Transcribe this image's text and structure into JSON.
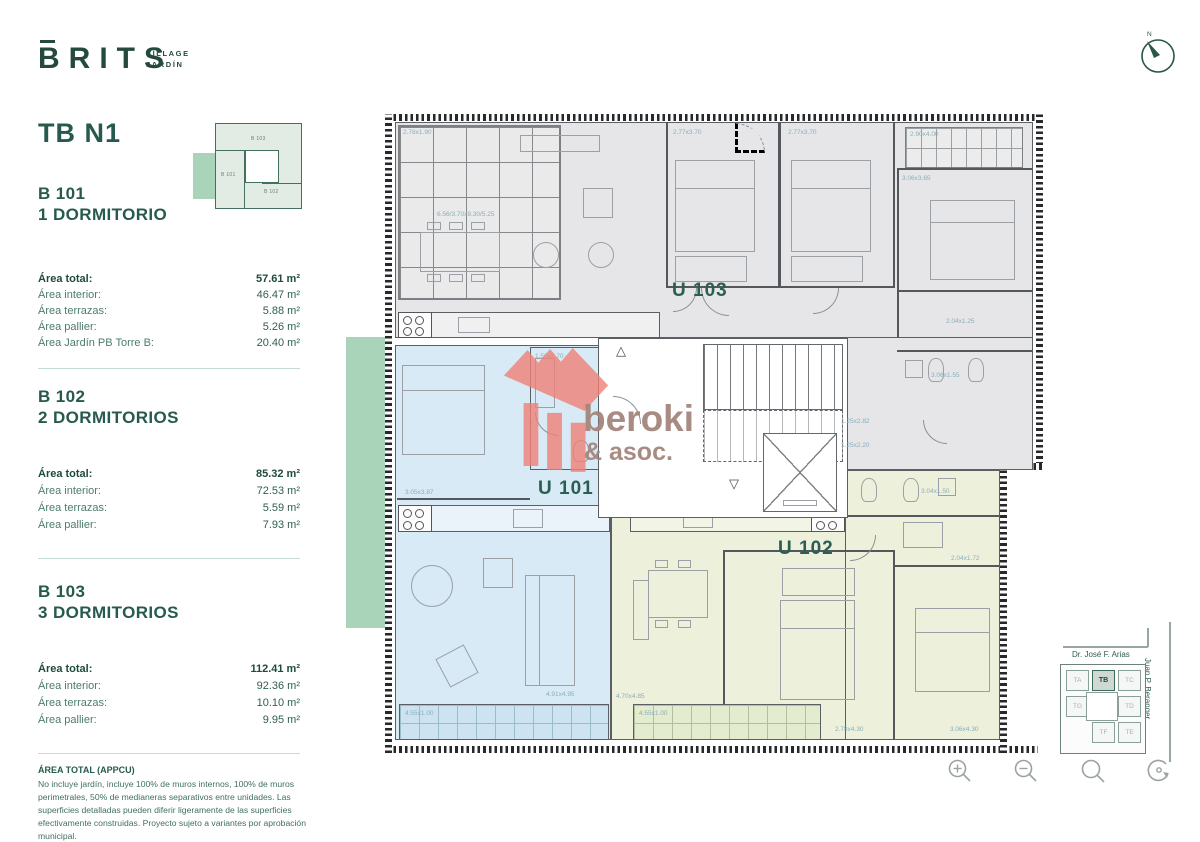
{
  "brand": {
    "name": "BRITS",
    "tag_line1": "VILLAGE",
    "tag_line2": "JARDÍN"
  },
  "compass": {
    "north": "N"
  },
  "sidebar": {
    "plan_title": "TB N1",
    "keyplan": {
      "b103": "B 103",
      "b101": "B 101",
      "b102": "B 102"
    },
    "units": [
      {
        "code": "B 101",
        "type": "1 DORMITORIO",
        "rows": [
          {
            "label": "Área total:",
            "value": "57.61 m²"
          },
          {
            "label": "Área interior:",
            "value": "46.47 m²"
          },
          {
            "label": "Área terrazas:",
            "value": "5.88 m²"
          },
          {
            "label": "Área pallier:",
            "value": "5.26 m²"
          },
          {
            "label": "Área Jardín PB Torre B:",
            "value": "20.40 m²"
          }
        ]
      },
      {
        "code": "B 102",
        "type": "2 DORMITORIOS",
        "rows": [
          {
            "label": "Área total:",
            "value": "85.32 m²"
          },
          {
            "label": "Área interior:",
            "value": "72.53 m²"
          },
          {
            "label": "Área terrazas:",
            "value": "5.59 m²"
          },
          {
            "label": "Área pallier:",
            "value": "7.93 m²"
          }
        ]
      },
      {
        "code": "B 103",
        "type": "3 DORMITORIOS",
        "rows": [
          {
            "label": "Área total:",
            "value": "112.41 m²"
          },
          {
            "label": "Área interior:",
            "value": "92.36 m²"
          },
          {
            "label": "Área terrazas:",
            "value": "10.10 m²"
          },
          {
            "label": "Área pallier:",
            "value": "9.95 m²"
          }
        ]
      }
    ],
    "footnote": {
      "title": "ÁREA TOTAL (APPCU)",
      "body": "No incluye jardín, incluye 100% de muros internos, 100% de muros perimetrales, 50% de medianeras separativos entre unidades. Las superficies detalladas pueden diferir ligeramente de las superficies efectivamente construidas. Proyecto sujeto a variantes por aprobación municipal."
    }
  },
  "plan": {
    "unit_labels": {
      "u101": "U 101",
      "u102": "U 102",
      "u103": "U 103"
    },
    "icons": {
      "stairs_up": "△",
      "stairs_down": "▽"
    },
    "dims": {
      "pergola": "2.78x1.90",
      "living103": "6.56/3.70x8.30/5.25",
      "bed103a": "2.77x3.70",
      "bed103b": "2.77x3.70",
      "terrace103": "2.90x4.00",
      "bed103c": "3.06x3.65",
      "bath103a": "2.04x1.25",
      "bath103b": "3.06x1.55",
      "hall103": "1.25x2.82",
      "hall102": "1.25x2.20",
      "bath102": "3.04x1.50",
      "dress102": "2.04x1.72",
      "bed102a": "2.78x4.30",
      "bed102b": "3.06x4.30",
      "bath101": "1.50x2.70",
      "bed101": "3.05x3.87",
      "living101": "4.91x4.95",
      "living102": "4.70x4.85",
      "terrace101": "4.55x1.00",
      "terrace102": "4.55x1.00"
    },
    "watermark": {
      "name": "beroki",
      "sub": "& asoc."
    }
  },
  "minimap": {
    "street_top": "Dr. José F. Arias",
    "street_right": "Juan P. Beranger",
    "towers": {
      "ta": "TA",
      "tb": "TB",
      "tc": "TC",
      "tg": "TG",
      "td": "TD",
      "tf": "TF",
      "te": "TE"
    }
  }
}
